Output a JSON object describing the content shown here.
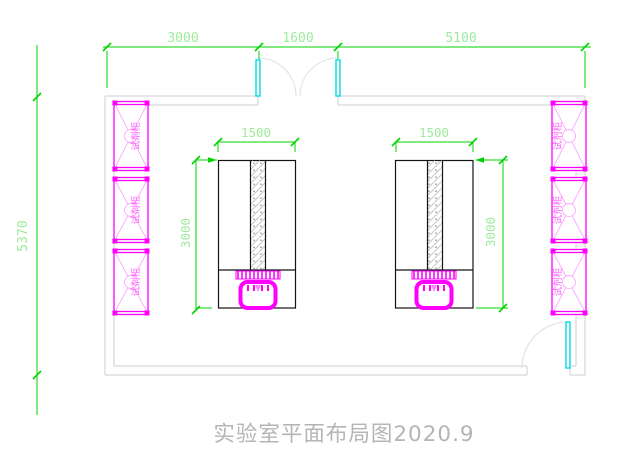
{
  "drawing": {
    "title": "实验室平面布局图2020.9",
    "cabinet_label": "试剂柜",
    "dims": {
      "top_left": "3000",
      "top_middle": "1600",
      "top_right": "5100",
      "left_overall": "5370",
      "bench_width": "1500",
      "bench_depth": "3000"
    },
    "colors": {
      "dimension_line": "#00d400",
      "dimension_text": "#9ceb9c",
      "cabinet_magenta": "#ff00ff",
      "cabinet_light": "#ffa6ff",
      "door_cyan": "#00dde6",
      "wall_gray": "#cccccc",
      "bench_black": "#141414",
      "hatch_gray": "#c4c4c4",
      "title_gray": "#b5b5b5"
    }
  }
}
